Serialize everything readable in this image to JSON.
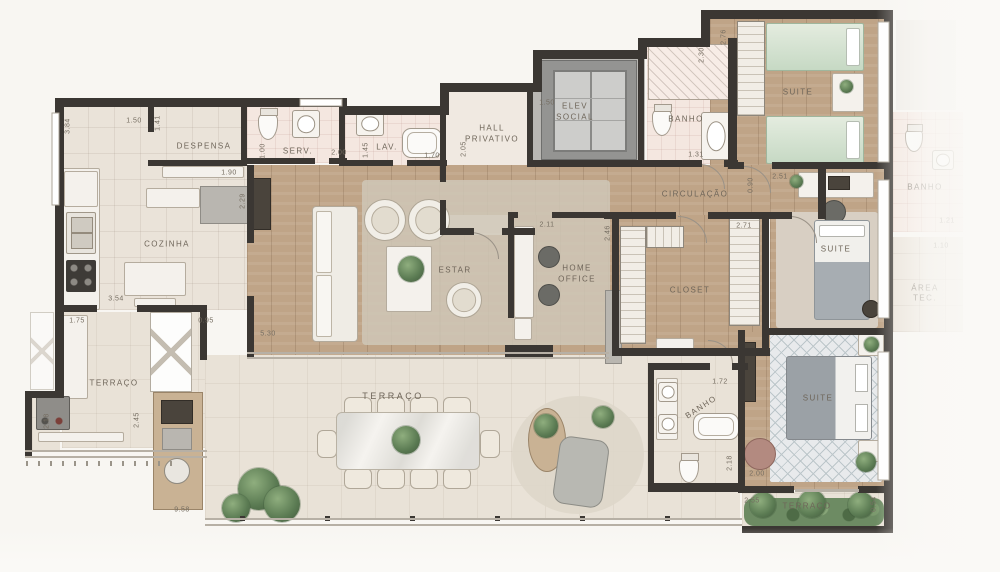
{
  "plan_title": "apartment-floor-plan",
  "labels": {
    "despensa": "DESPENSA",
    "serv": "SERV.",
    "lav": "LAV.",
    "hall_l1": "HALL",
    "hall_l2": "PRIVATIVO",
    "elev_l1": "ELEV",
    "elev_l2": "SOCIAL",
    "banho": "BANHO",
    "suite": "SUITE",
    "circulacao": "CIRCULAÇÃO",
    "cozinha": "COZINHA",
    "estar": "ESTAR",
    "home_l1": "HOME",
    "home_l2": "OFFICE",
    "closet": "CLOSET",
    "area_l1": "ÁREA",
    "area_l2": "TEC.",
    "terraco": "TERRAÇO"
  },
  "dims": {
    "d384": "3.84",
    "d150a": "1.50",
    "d141": "1.41",
    "d190": "1.90",
    "d100": "1.00",
    "d200a": "2.00",
    "d229": "2.29",
    "d145": "1.45",
    "d170": "1.70",
    "d150b": "1.50",
    "d205": "2.05",
    "d276": "2.76",
    "d230": "2.30",
    "d131": "1.31",
    "d090": "0.90",
    "d251": "2.51",
    "d211": "2.11",
    "d246": "2.46",
    "d271": "2.71",
    "d354": "3.54",
    "d175": "1.75",
    "d095": "0.95",
    "d530": "5.30",
    "d218a": "2.18",
    "d245": "2.45",
    "d958": "9.58",
    "d172": "1.72",
    "d218b": "2.18",
    "d200b": "2.00",
    "d255": "2.55",
    "d054": "0.54",
    "d121": "1.21",
    "d110": "1.10"
  },
  "colors": {
    "wall": "#3b3733",
    "wood_floor": "#bfa487",
    "tile_floor": "#eae3d9",
    "bath_floor": "#f4e7e0",
    "green_bedding": "#c6d9c4",
    "plant_green": "#5a7a52",
    "label_text": "#6e6559"
  }
}
